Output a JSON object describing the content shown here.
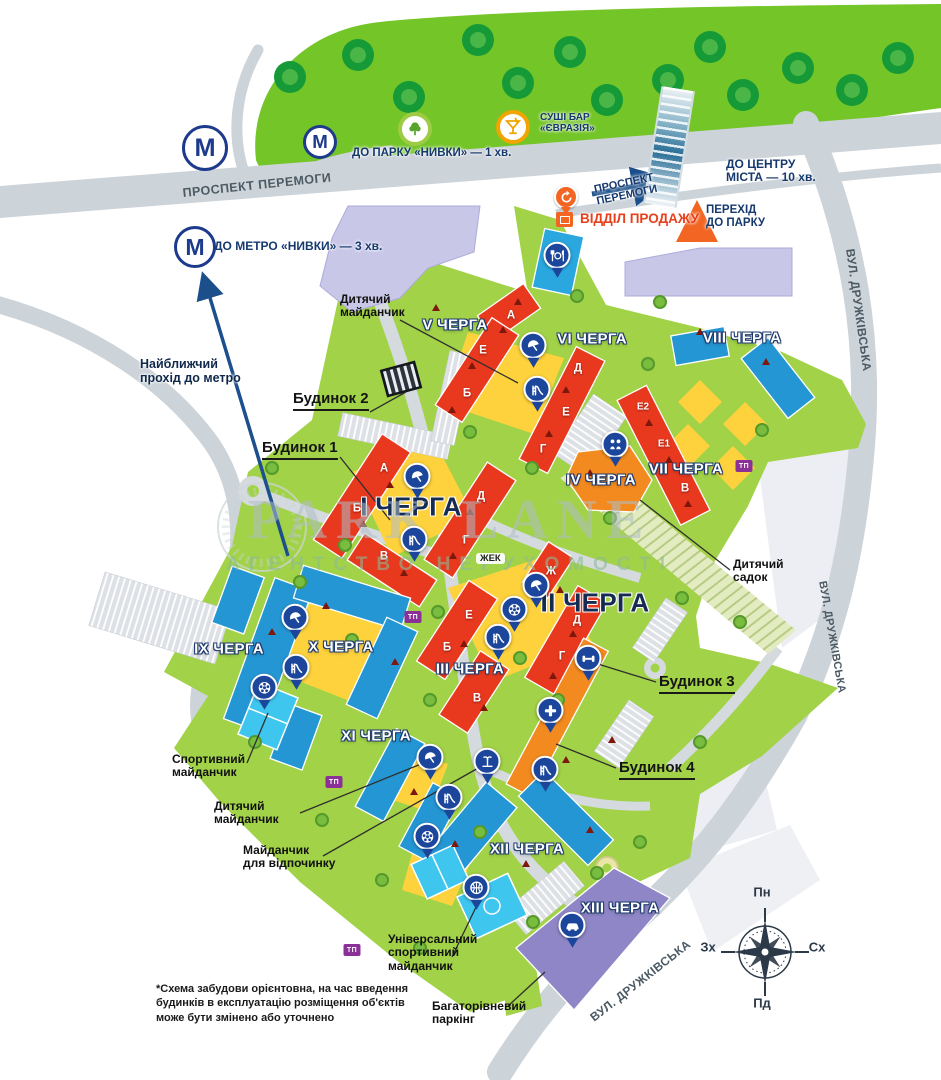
{
  "map": {
    "watermark": {
      "title": "PARK LANE",
      "subtitle": "АГЕНТСТВО НЕРУХОМОСТІ"
    },
    "footnote": "*Схема забудови орієнтовна, на час введення\nбудинків в експлуатацію розміщення об'єктів\nможе бути змінено або уточнено",
    "compass": {
      "n": "Пн",
      "e": "Сх",
      "s": "Пд",
      "w": "Зх"
    },
    "compass_positions": {
      "n": [
        762,
        893
      ],
      "e": [
        817,
        948
      ],
      "s": [
        762,
        1004
      ],
      "w": [
        708,
        948
      ]
    },
    "metro_letter": "М",
    "zhek_label": "ЖЕК",
    "tp_label": "ТП",
    "tp_positions": [
      [
        413,
        617
      ],
      [
        744,
        466
      ],
      [
        334,
        782
      ],
      [
        352,
        950
      ]
    ],
    "metro_icons": [
      {
        "x": 205,
        "y": 148,
        "d": 46
      },
      {
        "x": 320,
        "y": 142,
        "d": 34
      },
      {
        "x": 195,
        "y": 247,
        "d": 42
      }
    ],
    "poi_icons": [
      {
        "icon": "park-tree",
        "x": 415,
        "y": 129,
        "ring": "#9ecb44"
      },
      {
        "icon": "cocktail",
        "x": 513,
        "y": 127,
        "ring": "#f0a500"
      }
    ],
    "direction_labels": [
      {
        "id": "to-park",
        "text": "ДО ПАРКУ «НИВКИ» — 1 хв.",
        "x": 352,
        "y": 147,
        "size": 11.5
      },
      {
        "id": "to-metro",
        "text": "ДО МЕТРО «НИВКИ» — 3 хв.",
        "x": 214,
        "y": 240,
        "size": 12
      },
      {
        "id": "to-center",
        "text": "ДО ЦЕНТРУ\nМІСТА — 10 хв.",
        "x": 726,
        "y": 158,
        "size": 12
      },
      {
        "id": "crossing-to-park",
        "text": "ПЕРЕХІД\nДО ПАРКУ",
        "x": 706,
        "y": 204,
        "size": 11.5
      },
      {
        "id": "sushi-bar",
        "text": "СУШІ БАР\n«ЄВРАЗІЯ»",
        "x": 540,
        "y": 112,
        "size": 10
      },
      {
        "id": "metro-path",
        "text": "Найближчий\nпрохід до метро",
        "x": 140,
        "y": 357,
        "size": 12.5,
        "color": "#10284a"
      },
      {
        "id": "sales-office",
        "text": "ВІДДІЛ ПРОДАЖУ",
        "x": 580,
        "y": 211,
        "size": 13.5,
        "color": "#e8401c"
      },
      {
        "id": "avenue-direction",
        "text": "ПРОСПЕКТ\nПЕРЕМОГИ",
        "x": 593,
        "y": 184,
        "size": 11,
        "rot": -12
      }
    ],
    "road_labels": [
      {
        "id": "avenue",
        "text": "ПРОСПЕКТ ПЕРЕМОГИ",
        "x": 182,
        "y": 186,
        "rot": -6,
        "size": 12.5
      },
      {
        "id": "druzhkivska-top",
        "text": "ВУЛ. ДРУЖКІВСЬКА",
        "x": 856,
        "y": 248,
        "rot": 82,
        "size": 12
      },
      {
        "id": "druzhkivska-mid",
        "text": "ВУЛ. ДРУЖКІВСЬКА",
        "x": 828,
        "y": 580,
        "rot": 80,
        "size": 11
      },
      {
        "id": "druzhkivska-bottom",
        "text": "ВУЛ. ДРУЖКІВСЬКА",
        "x": 588,
        "y": 1014,
        "rot": -38,
        "size": 12
      }
    ],
    "phase_labels": [
      {
        "text": "V ЧЕРГА",
        "x": 455,
        "y": 326,
        "style": "outline"
      },
      {
        "text": "VI ЧЕРГА",
        "x": 592,
        "y": 340,
        "style": "outline"
      },
      {
        "text": "VIII ЧЕРГА",
        "x": 742,
        "y": 339,
        "style": "outline"
      },
      {
        "text": "VII ЧЕРГА",
        "x": 686,
        "y": 470,
        "style": "outline"
      },
      {
        "text": "IV ЧЕРГА",
        "x": 601,
        "y": 481,
        "style": "outline"
      },
      {
        "text": "І ЧЕРГА",
        "x": 411,
        "y": 507,
        "style": "dark"
      },
      {
        "text": "ІІ ЧЕРГА",
        "x": 595,
        "y": 603,
        "style": "dark"
      },
      {
        "text": "ІІІ ЧЕРГА",
        "x": 470,
        "y": 670,
        "style": "outline"
      },
      {
        "text": "IX ЧЕРГА",
        "x": 229,
        "y": 650,
        "style": "outline"
      },
      {
        "text": "X ЧЕРГА",
        "x": 341,
        "y": 648,
        "style": "outline"
      },
      {
        "text": "XI ЧЕРГА",
        "x": 376,
        "y": 737,
        "style": "outline"
      },
      {
        "text": "XII ЧЕРГА",
        "x": 527,
        "y": 850,
        "style": "outline"
      },
      {
        "text": "XIII ЧЕРГА",
        "x": 620,
        "y": 909,
        "style": "outline"
      }
    ],
    "unit_labels": [
      {
        "t": "А",
        "x": 511,
        "y": 316
      },
      {
        "t": "Е",
        "x": 483,
        "y": 351
      },
      {
        "t": "Б",
        "x": 467,
        "y": 394
      },
      {
        "t": "Д",
        "x": 578,
        "y": 369
      },
      {
        "t": "Е",
        "x": 566,
        "y": 413
      },
      {
        "t": "Г",
        "x": 543,
        "y": 450
      },
      {
        "t": "Е2",
        "x": 643,
        "y": 407
      },
      {
        "t": "Е1",
        "x": 664,
        "y": 444
      },
      {
        "t": "В",
        "x": 685,
        "y": 489
      },
      {
        "t": "А",
        "x": 384,
        "y": 469
      },
      {
        "t": "Б",
        "x": 357,
        "y": 509
      },
      {
        "t": "В",
        "x": 384,
        "y": 557
      },
      {
        "t": "Д",
        "x": 481,
        "y": 497
      },
      {
        "t": "Г",
        "x": 466,
        "y": 541
      },
      {
        "t": "Ж",
        "x": 551,
        "y": 572
      },
      {
        "t": "Д",
        "x": 577,
        "y": 621
      },
      {
        "t": "Г",
        "x": 562,
        "y": 657
      },
      {
        "t": "Е",
        "x": 469,
        "y": 616
      },
      {
        "t": "Б",
        "x": 447,
        "y": 648
      },
      {
        "t": "В",
        "x": 477,
        "y": 699
      }
    ],
    "house_callouts": [
      {
        "text": "Будинок 2",
        "x": 293,
        "y": 391,
        "line": [
          370,
          412,
          406,
          392
        ]
      },
      {
        "text": "Будинок 1",
        "x": 262,
        "y": 440,
        "line": [
          340,
          457,
          390,
          520
        ]
      },
      {
        "text": "Будинок 3",
        "x": 659,
        "y": 674,
        "line": [
          656,
          682,
          585,
          660
        ]
      },
      {
        "text": "Будинок 4",
        "x": 619,
        "y": 760,
        "line": [
          616,
          768,
          556,
          744
        ]
      }
    ],
    "amenity_callouts": [
      {
        "text": "Дитячий\nмайданчик",
        "x": 340,
        "y": 293,
        "line": [
          400,
          320,
          518,
          383
        ]
      },
      {
        "text": "Дитячий\nсадок",
        "x": 733,
        "y": 558,
        "line": [
          730,
          570,
          640,
          500
        ]
      },
      {
        "text": "Спортивний\nмайданчик",
        "x": 172,
        "y": 753,
        "line": [
          247,
          763,
          268,
          713
        ]
      },
      {
        "text": "Дитячий\nмайданчик",
        "x": 214,
        "y": 800,
        "line": [
          300,
          813,
          426,
          762
        ]
      },
      {
        "text": "Майданчик\nдля відпочинку",
        "x": 243,
        "y": 844,
        "line": [
          323,
          856,
          480,
          767
        ]
      },
      {
        "text": "Універсальний\nспортивний\nмайданчик",
        "x": 388,
        "y": 933,
        "line": [
          452,
          957,
          477,
          905
        ]
      },
      {
        "text": "Багаторівневий\nпаркінг",
        "x": 432,
        "y": 1000,
        "line": [
          508,
          1006,
          545,
          972
        ]
      }
    ],
    "pins": [
      {
        "icon": "restaurant",
        "x": 557,
        "y": 258
      },
      {
        "icon": "umbrella",
        "x": 533,
        "y": 348
      },
      {
        "icon": "slide",
        "x": 537,
        "y": 392
      },
      {
        "icon": "children",
        "x": 615,
        "y": 447
      },
      {
        "icon": "umbrella",
        "x": 417,
        "y": 479
      },
      {
        "icon": "slide",
        "x": 414,
        "y": 542
      },
      {
        "icon": "umbrella",
        "x": 536,
        "y": 588
      },
      {
        "icon": "wheel",
        "x": 514,
        "y": 612
      },
      {
        "icon": "slide",
        "x": 498,
        "y": 640
      },
      {
        "icon": "dumbbell",
        "x": 588,
        "y": 661
      },
      {
        "icon": "cross",
        "x": 550,
        "y": 713
      },
      {
        "icon": "fountain",
        "x": 487,
        "y": 764
      },
      {
        "icon": "slide",
        "x": 545,
        "y": 772
      },
      {
        "icon": "umbrella",
        "x": 295,
        "y": 620
      },
      {
        "icon": "slide",
        "x": 296,
        "y": 670
      },
      {
        "icon": "wheel",
        "x": 264,
        "y": 690
      },
      {
        "icon": "umbrella",
        "x": 430,
        "y": 760
      },
      {
        "icon": "slide",
        "x": 449,
        "y": 800
      },
      {
        "icon": "wheel",
        "x": 427,
        "y": 839
      },
      {
        "icon": "basketball",
        "x": 476,
        "y": 890
      },
      {
        "icon": "car",
        "x": 572,
        "y": 928
      }
    ],
    "colors": {
      "pin_blue": "#1c469b",
      "building_red": "#e8391f",
      "building_orange": "#f28a1f",
      "building_blue": "#2596d4",
      "parking_purple": "#8e86c6",
      "park_green": "#74c527",
      "complex_green": "#a2d247",
      "road_gray": "#ccd3d9",
      "courtyard_yellow": "#fdd23c",
      "navy_text": "#16396e",
      "sales_red": "#e8401c"
    }
  }
}
